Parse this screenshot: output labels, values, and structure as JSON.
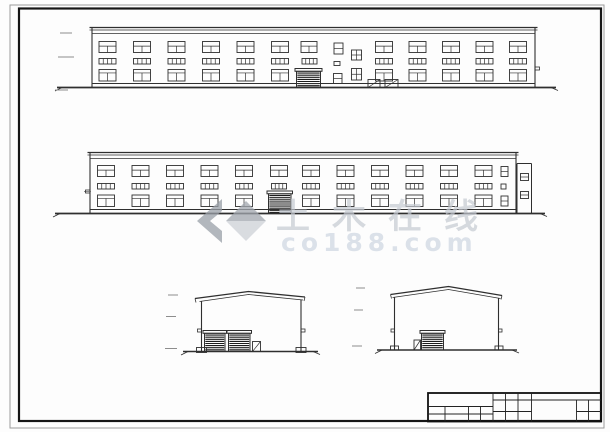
{
  "canvas": {
    "w": 610,
    "h": 432,
    "bg": "#ffffff",
    "line_color": "#2f2f2f"
  },
  "sheet": {
    "outer": {
      "x": 10,
      "y": 5,
      "w": 594,
      "h": 423,
      "color": "#9c9c9c",
      "sw": 1
    },
    "inner": {
      "x": 19,
      "y": 8.5,
      "w": 582,
      "h": 412.5,
      "color": "#151515",
      "sw": 2.2
    }
  },
  "elevations": [
    {
      "name": "side-elevation-1",
      "x1": 92,
      "x2": 535,
      "band": [
        27.5,
        30,
        33.5
      ],
      "rows": [
        {
          "kind": "std1",
          "y": 41.5,
          "h": 11
        },
        {
          "kind": "strip",
          "y": 58.5,
          "h": 5.5
        },
        {
          "kind": "std3",
          "y": 69.5,
          "h": 11.5
        }
      ],
      "win_w": 17,
      "cols": [
        99,
        133.5,
        168,
        202.5,
        237,
        271.5,
        375.5,
        409,
        442.5,
        476,
        509.5
      ],
      "door": {
        "x": 296.5,
        "w": 24,
        "top": 68.5
      },
      "extras": [
        {
          "kind": "std1",
          "x": 301,
          "y": 41.5,
          "w": 16,
          "h": 11
        },
        {
          "kind": "strip",
          "x": 302,
          "y": 58.5,
          "w": 15,
          "h": 5.5
        },
        {
          "kind": "win2",
          "x": 334,
          "y": 43,
          "w": 9,
          "h": 11
        },
        {
          "kind": "plain",
          "x": 334,
          "y": 61.5,
          "w": 6,
          "h": 4
        },
        {
          "kind": "win2",
          "x": 333.5,
          "y": 73.5,
          "w": 8.5,
          "h": 10
        },
        {
          "kind": "cross",
          "x": 351.5,
          "y": 50,
          "w": 10,
          "h": 10
        },
        {
          "kind": "cross",
          "x": 351.5,
          "y": 68.5,
          "w": 10,
          "h": 11.5
        },
        {
          "kind": "ramp",
          "x": 368,
          "y": 79.5,
          "w": 12,
          "h": 8
        },
        {
          "kind": "ramp",
          "x": 385,
          "y": 79.5,
          "w": 13,
          "h": 8
        }
      ],
      "wall_bottom": 83.5,
      "ground": {
        "x1": 57,
        "x2": 556,
        "y": 87.5
      },
      "marks": [
        [
          60,
          33,
          12
        ],
        [
          58,
          57,
          16
        ],
        [
          55,
          90,
          13
        ]
      ],
      "ticks": [
        [
          535,
          67,
          4.5,
          3
        ]
      ]
    },
    {
      "name": "side-elevation-2",
      "x1": 90,
      "x2": 516,
      "band": [
        152.5,
        155,
        158.5
      ],
      "rows": [
        {
          "kind": "std1",
          "y": 165.5,
          "h": 11
        },
        {
          "kind": "strip",
          "y": 183.5,
          "h": 5.5
        },
        {
          "kind": "std3",
          "y": 195,
          "h": 11.5
        }
      ],
      "win_w": 17,
      "cols": [
        97.5,
        132,
        166.5,
        201,
        235.5,
        302.5,
        337,
        371.5,
        406,
        440.5,
        475
      ],
      "door": {
        "x": 268.5,
        "w": 22.5,
        "top": 191
      },
      "extras": [
        {
          "kind": "std1",
          "x": 270.5,
          "y": 165.5,
          "w": 17,
          "h": 11
        },
        {
          "kind": "strip",
          "x": 271.5,
          "y": 183.5,
          "w": 15,
          "h": 5.5
        },
        {
          "kind": "win2",
          "x": 501,
          "y": 166.5,
          "w": 7,
          "h": 10
        },
        {
          "kind": "plain",
          "x": 501,
          "y": 184,
          "w": 5,
          "h": 5
        },
        {
          "kind": "win2",
          "x": 501,
          "y": 196,
          "w": 7,
          "h": 10
        }
      ],
      "wall_bottom": 209.5,
      "ground": {
        "x1": 55,
        "x2": 545,
        "y": 213.5
      },
      "marks": [
        [
          84,
          191.5,
          7
        ]
      ],
      "ticks": [
        [
          85.5,
          190,
          4.5,
          3
        ]
      ],
      "annex": {
        "x": 517,
        "w": 14.5,
        "top": 163.5,
        "windows": [
          [
            520.5,
            173.5,
            8,
            7
          ],
          [
            520.5,
            191.5,
            8,
            7
          ]
        ]
      }
    }
  ],
  "gables": [
    {
      "name": "end-elevation-1",
      "eave_l": [
        195,
        298.5
      ],
      "ridge": [
        248.5,
        291.5
      ],
      "eave_r": [
        305,
        297
      ],
      "wall_l": 201.5,
      "wall_r": 301,
      "base": 351.5,
      "doors": [
        {
          "x": 204.5,
          "w": 20.5
        },
        {
          "x": 228.5,
          "w": 21.5
        }
      ],
      "door_top": 330.5,
      "small_door": {
        "x": 252.5,
        "y": 341.5,
        "w": 8,
        "h": 10
      },
      "plinths": [
        [
          196.5,
          347.5,
          10,
          5
        ],
        [
          296,
          347.5,
          10,
          5
        ]
      ],
      "ticks": [
        [
          197.5,
          329,
          4,
          3
        ],
        [
          301,
          329,
          4,
          3
        ]
      ],
      "ground": {
        "x1": 183,
        "x2": 318,
        "y": 351.5
      },
      "marks": [
        [
          168,
          295,
          10
        ],
        [
          166,
          316.5,
          10
        ],
        [
          165,
          348.5,
          12
        ]
      ]
    },
    {
      "name": "end-elevation-2",
      "eave_l": [
        390.5,
        294.5
      ],
      "ridge": [
        448.5,
        286.5
      ],
      "eave_r": [
        502,
        295.5
      ],
      "wall_l": 394.5,
      "wall_r": 498.5,
      "base": 350,
      "doors": [
        {
          "x": 421.5,
          "w": 22
        }
      ],
      "door_top": 330.5,
      "small_door": {
        "x": 414,
        "y": 340,
        "w": 6.5,
        "h": 10
      },
      "plinths": [
        [
          390.5,
          346,
          8,
          4
        ],
        [
          495,
          346,
          8,
          4
        ]
      ],
      "ticks": [
        [
          391,
          329,
          3.5,
          3
        ],
        [
          498.5,
          329,
          3.5,
          3
        ]
      ],
      "ground": {
        "x1": 377,
        "x2": 517,
        "y": 350
      },
      "marks": [
        [
          356,
          288,
          9
        ],
        [
          354,
          310,
          9
        ],
        [
          352,
          346,
          10
        ]
      ]
    }
  ],
  "title_block": {
    "box": [
      428,
      393,
      601,
      421.5
    ],
    "lines": [
      [
        493,
        393,
        493,
        421.5
      ],
      [
        505.5,
        393,
        505.5,
        421.5
      ],
      [
        518,
        393,
        518,
        421.5
      ],
      [
        531.5,
        393,
        531.5,
        421.5
      ],
      [
        576.5,
        400,
        576.5,
        421.5
      ],
      [
        588.5,
        400,
        588.5,
        421.5
      ],
      [
        445,
        406.5,
        445,
        421.5
      ],
      [
        468.5,
        406.5,
        468.5,
        421.5
      ],
      [
        480.5,
        406.5,
        480.5,
        421.5
      ],
      [
        493,
        400,
        601,
        400
      ],
      [
        428,
        406.5,
        493,
        406.5
      ],
      [
        428,
        414,
        493,
        414
      ],
      [
        493,
        411.5,
        531.5,
        411.5
      ],
      [
        576.5,
        411.5,
        601,
        411.5
      ]
    ]
  },
  "watermark": {
    "logo": {
      "x": 197,
      "y": 199,
      "chevron_color": "#9aa0a8",
      "diamond_top_color": "#a2a7af",
      "diamond_bottom_color": "#cdd1d7",
      "opacity": 0.75
    },
    "line1": {
      "text": "土木在线",
      "x": 276,
      "y": 228,
      "size": 34,
      "spacing": 22,
      "color": "#c5cad2",
      "opacity": 0.7
    },
    "line2": {
      "text": "co188.com",
      "x": 281,
      "y": 251,
      "size": 25,
      "spacing": 5,
      "color": "#d6dde6",
      "opacity": 0.85
    }
  }
}
